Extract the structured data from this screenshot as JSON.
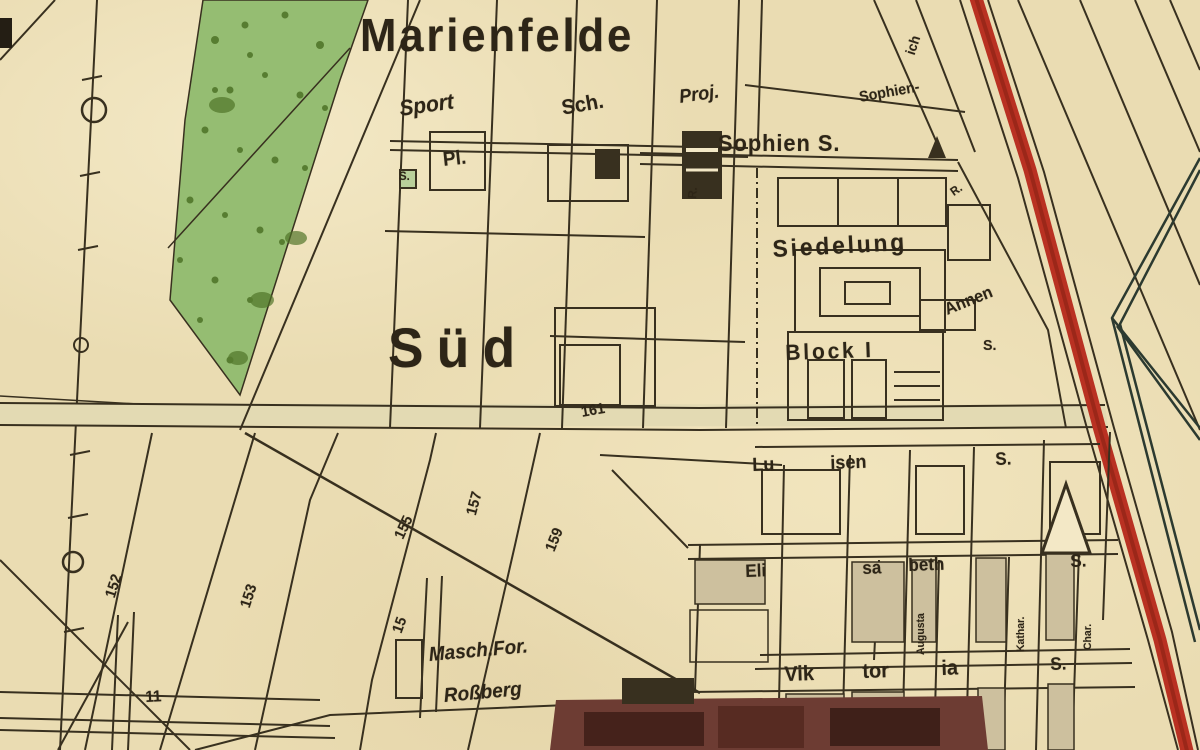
{
  "map": {
    "title": "Marienfelde",
    "district": "Süd",
    "palette": {
      "paper": "#eadcb2",
      "paper_light": "#f3e8c6",
      "ink": "#38301f",
      "ink_text": "#2d2517",
      "green_area": "#95bd72",
      "green_trees": "#4d7226",
      "red_road": "#b93122",
      "red_road_dark": "#8f2416",
      "rail": "#2c3a30",
      "block_tan": "#cdc09e",
      "factory_dark": "#6d3c33",
      "factory_darker": "#45221b",
      "road_fill": "#e3dab3"
    },
    "symbols": [
      {
        "name": "church-triangle-small",
        "desc": "filled triangle beside Sophien S."
      },
      {
        "name": "landmark-triangle-large",
        "desc": "hollow triangle landmark lower right"
      },
      {
        "name": "boundary-circle-markers",
        "desc": "circles on western boundary line"
      }
    ],
    "labels": [
      {
        "name": "town-title",
        "text": "Marienfelde",
        "x": 360,
        "y": 12,
        "size": 46,
        "rot": 0,
        "ls": 3,
        "bold": true
      },
      {
        "name": "district-sued",
        "text": "Süd",
        "x": 388,
        "y": 320,
        "size": 56,
        "rot": 0,
        "ls": 14,
        "bold": true
      },
      {
        "name": "sport-label",
        "text": "Sport",
        "x": 398,
        "y": 98,
        "size": 22,
        "rot": -8,
        "italic": true,
        "bold": true
      },
      {
        "name": "sport-platz-label",
        "text": "Pl.",
        "x": 442,
        "y": 150,
        "size": 20,
        "rot": -6,
        "bold": true
      },
      {
        "name": "sport-s-label",
        "text": "S.",
        "x": 399,
        "y": 170,
        "size": 12,
        "rot": 0,
        "bold": true
      },
      {
        "name": "school-label",
        "text": "Sch.",
        "x": 560,
        "y": 98,
        "size": 21,
        "rot": -10,
        "bold": true
      },
      {
        "name": "proj-label",
        "text": "Proj.",
        "x": 678,
        "y": 88,
        "size": 19,
        "rot": -8,
        "italic": true,
        "bold": true
      },
      {
        "name": "sophien-street-label",
        "text": "Sophien-",
        "x": 858,
        "y": 90,
        "size": 15,
        "rot": -10,
        "bold": true
      },
      {
        "name": "sophien-s-label",
        "text": "Sophien S.",
        "x": 718,
        "y": 132,
        "size": 23,
        "rot": 0,
        "ls": 1,
        "bold": true
      },
      {
        "name": "r-mark-west",
        "text": "R.",
        "x": 686,
        "y": 198,
        "size": 12,
        "rot": -85,
        "bold": true
      },
      {
        "name": "r-mark-east",
        "text": "R.",
        "x": 948,
        "y": 188,
        "size": 12,
        "rot": -35,
        "bold": true
      },
      {
        "name": "siedelung-label",
        "text": "Siedelung",
        "x": 772,
        "y": 238,
        "size": 24,
        "rot": -3,
        "ls": 3,
        "bold": true
      },
      {
        "name": "annen-label",
        "text": "Annen",
        "x": 942,
        "y": 302,
        "size": 17,
        "rot": -22,
        "bold": true
      },
      {
        "name": "annen-s-label",
        "text": "S.",
        "x": 983,
        "y": 338,
        "size": 15,
        "rot": 0,
        "bold": true
      },
      {
        "name": "block-i-label",
        "text": "Block I",
        "x": 785,
        "y": 342,
        "size": 22,
        "rot": -2,
        "ls": 3,
        "bold": true
      },
      {
        "name": "road-number-161",
        "text": "161",
        "x": 580,
        "y": 405,
        "size": 15,
        "rot": -10,
        "bold": true
      },
      {
        "name": "luisen-lu-label",
        "text": "Lu",
        "x": 752,
        "y": 456,
        "size": 19,
        "rot": -2,
        "bold": true
      },
      {
        "name": "luisen-isen-label",
        "text": "isen",
        "x": 830,
        "y": 454,
        "size": 19,
        "rot": -2,
        "bold": true
      },
      {
        "name": "luisen-s-label",
        "text": "S.",
        "x": 995,
        "y": 450,
        "size": 18,
        "rot": -2,
        "bold": true
      },
      {
        "name": "elisabeth-eli-label",
        "text": "Eli",
        "x": 745,
        "y": 562,
        "size": 18,
        "rot": -2,
        "bold": true
      },
      {
        "name": "elisabeth-sa-label",
        "text": "sa",
        "x": 862,
        "y": 559,
        "size": 18,
        "rot": -2,
        "bold": true
      },
      {
        "name": "elisabeth-beth-label",
        "text": "beth",
        "x": 908,
        "y": 556,
        "size": 18,
        "rot": -2,
        "bold": true
      },
      {
        "name": "elisabeth-s-label",
        "text": "S.",
        "x": 1070,
        "y": 552,
        "size": 18,
        "rot": -2,
        "bold": true
      },
      {
        "name": "augusta-street-label",
        "text": "Augusta",
        "x": 916,
        "y": 655,
        "size": 11,
        "rot": -90,
        "bold": true
      },
      {
        "name": "kathar-street-label",
        "text": "Kathar.",
        "x": 1016,
        "y": 652,
        "size": 11,
        "rot": -90,
        "bold": true
      },
      {
        "name": "charl-street-label",
        "text": "Char.",
        "x": 1083,
        "y": 650,
        "size": 11,
        "rot": -90,
        "bold": true
      },
      {
        "name": "viktoria-vik-label",
        "text": "Vik",
        "x": 784,
        "y": 664,
        "size": 21,
        "rot": -2,
        "bold": true
      },
      {
        "name": "viktoria-tor-label",
        "text": "tor",
        "x": 862,
        "y": 661,
        "size": 21,
        "rot": -2,
        "bold": true
      },
      {
        "name": "viktoria-ia-label",
        "text": "ia",
        "x": 941,
        "y": 658,
        "size": 21,
        "rot": -2,
        "bold": true
      },
      {
        "name": "viktoria-s-label",
        "text": "S.",
        "x": 1050,
        "y": 655,
        "size": 18,
        "rot": -2,
        "bold": true
      },
      {
        "name": "masch-for-label",
        "text": "Masch.For.",
        "x": 428,
        "y": 645,
        "size": 20,
        "rot": -5,
        "italic": true,
        "bold": true
      },
      {
        "name": "rossberg-label",
        "text": "Roßberg",
        "x": 443,
        "y": 686,
        "size": 20,
        "rot": -5,
        "italic": true,
        "bold": true
      },
      {
        "name": "street-number-152",
        "text": "152",
        "x": 103,
        "y": 595,
        "size": 15,
        "rot": -72,
        "bold": true
      },
      {
        "name": "street-number-153",
        "text": "153",
        "x": 238,
        "y": 605,
        "size": 15,
        "rot": -72,
        "bold": true
      },
      {
        "name": "street-number-155",
        "text": "155",
        "x": 392,
        "y": 535,
        "size": 15,
        "rot": -65,
        "bold": true
      },
      {
        "name": "street-number-157",
        "text": "157",
        "x": 464,
        "y": 513,
        "size": 15,
        "rot": -75,
        "bold": true
      },
      {
        "name": "street-number-159",
        "text": "159",
        "x": 543,
        "y": 548,
        "size": 15,
        "rot": -68,
        "bold": true
      },
      {
        "name": "street-number-15",
        "text": "15",
        "x": 390,
        "y": 630,
        "size": 15,
        "rot": -70,
        "bold": true
      },
      {
        "name": "road-number-11",
        "text": "11",
        "x": 145,
        "y": 690,
        "size": 16,
        "rot": -3,
        "bold": true
      },
      {
        "name": "ich-street-fragment",
        "text": "ich",
        "x": 903,
        "y": 52,
        "size": 14,
        "rot": -72,
        "bold": true
      }
    ]
  }
}
